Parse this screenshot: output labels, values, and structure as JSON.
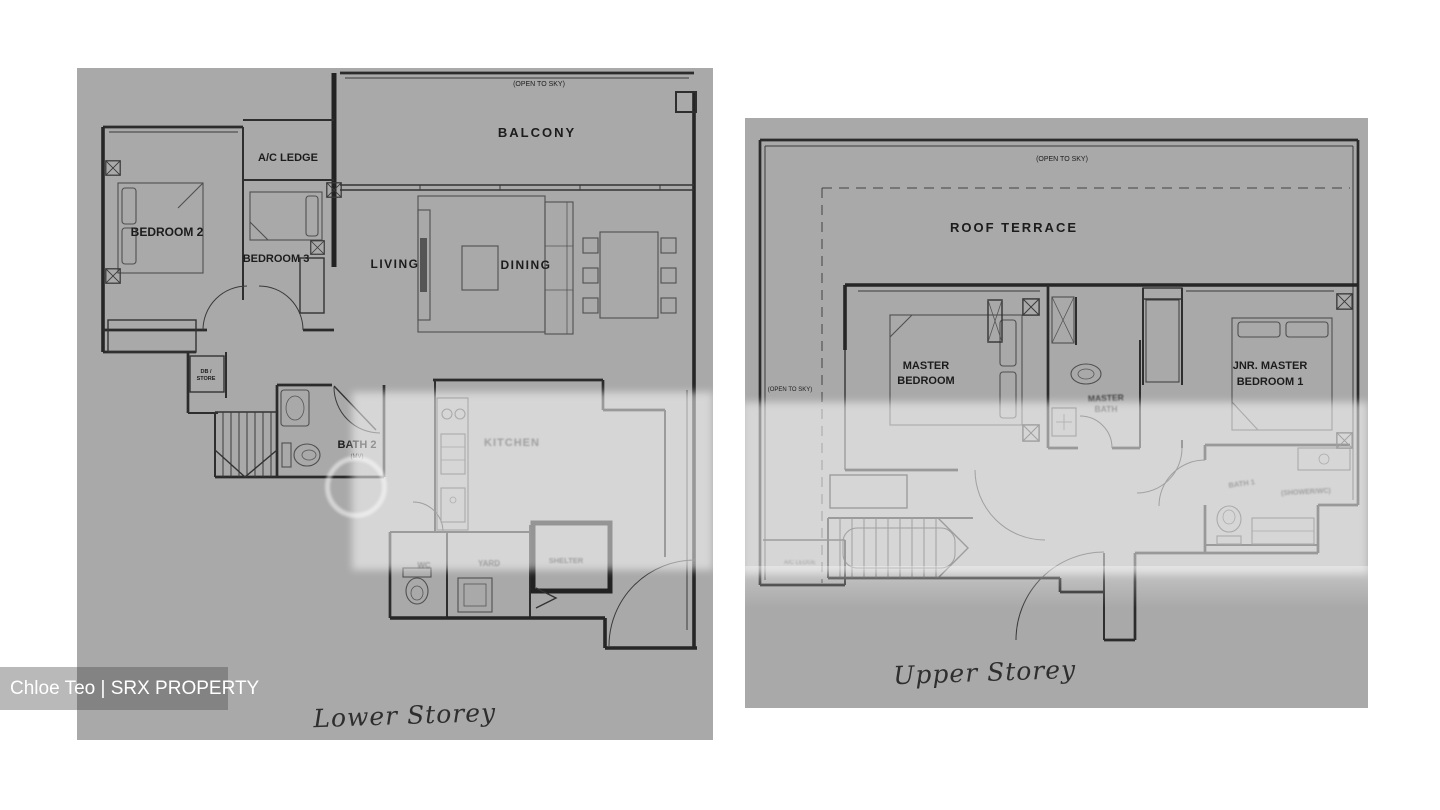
{
  "watermark": {
    "credit": "Chloe Teo | SRX PROPERTY"
  },
  "colors": {
    "panel": "#a9a9a9",
    "wall": "#2b2b2b",
    "label": "#1c1c1c"
  },
  "lower": {
    "caption": "Lower Storey",
    "open_to_sky": "(OPEN TO SKY)",
    "balcony": "BALCONY",
    "ac_ledge": "A/C LEDGE",
    "bedroom2": "BEDROOM 2",
    "bedroom3": "BEDROOM 3",
    "living": "LIVING",
    "dining": "DINING",
    "db_line1": "DB /",
    "db_line2": "STORE",
    "bath2": "BATH 2",
    "bath2_note": "(MV)",
    "kitchen": "KITCHEN",
    "wc": "WC",
    "yard": "YARD",
    "shelter": "SHELTER"
  },
  "upper": {
    "caption": "Upper Storey",
    "open_to_sky_top": "(OPEN TO SKY)",
    "open_to_sky_left": "(OPEN TO SKY)",
    "roof_terrace": "ROOF TERRACE",
    "master_line1": "MASTER",
    "master_line2": "BEDROOM",
    "master_bath_line1": "MASTER",
    "master_bath_line2": "BATH",
    "jnr_line1": "JNR. MASTER",
    "jnr_line2": "BEDROOM 1",
    "jnr_bath": "BATH 1",
    "jnr_bath_note": "(SHOWER/WC)",
    "ac_ledge": "A/C LEDGE"
  }
}
